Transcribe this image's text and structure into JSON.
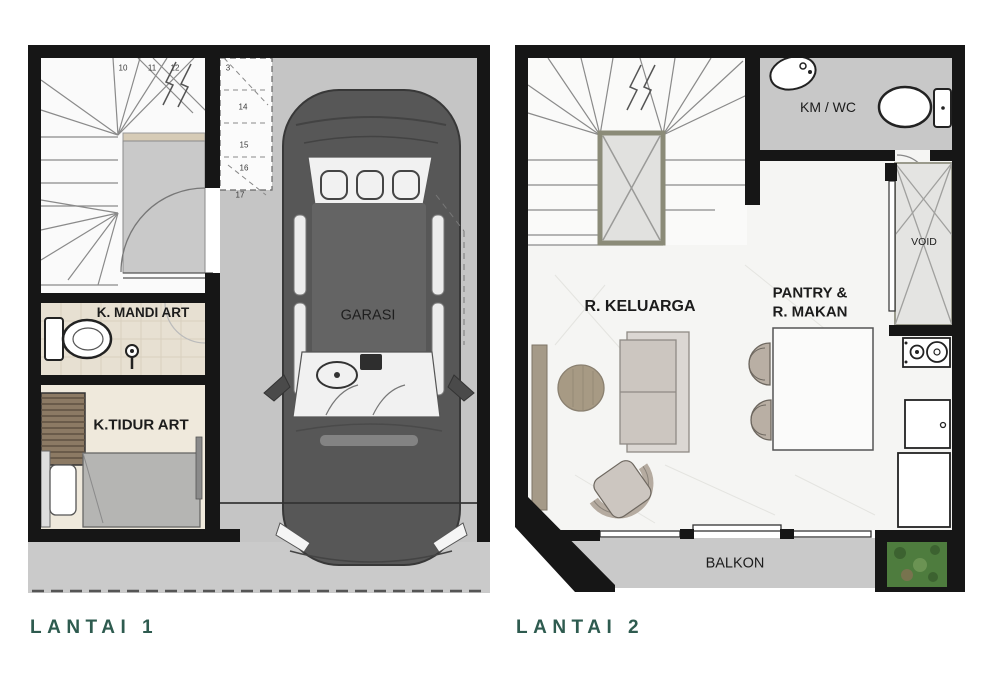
{
  "titles": {
    "floor1": "LANTAI 1",
    "floor2": "LANTAI 2"
  },
  "floor1": {
    "garage_label": "GARASI",
    "bathroom_label": "K. MANDI ART",
    "bedroom_label": "K.TIDUR ART",
    "stair_steps": [
      "10",
      "11",
      "12",
      "3",
      "14",
      "15",
      "16",
      "17"
    ]
  },
  "floor2": {
    "bathroom_label": "KM / WC",
    "void_label": "VOID",
    "family_room_label": "R. KELUARGA",
    "pantry_line1": "PANTRY &",
    "pantry_line2": "R. MAKAN",
    "balcony_label": "BALKON"
  },
  "colors": {
    "title_teal": "#2e5b4f",
    "wall_black": "#161616",
    "garage_floor": "#c5c5c5",
    "car_body": "#575757",
    "bath_floor": "#e7e0d2",
    "balcony_gray": "#c9c9c9",
    "planter_green": "#4e7c3e"
  }
}
